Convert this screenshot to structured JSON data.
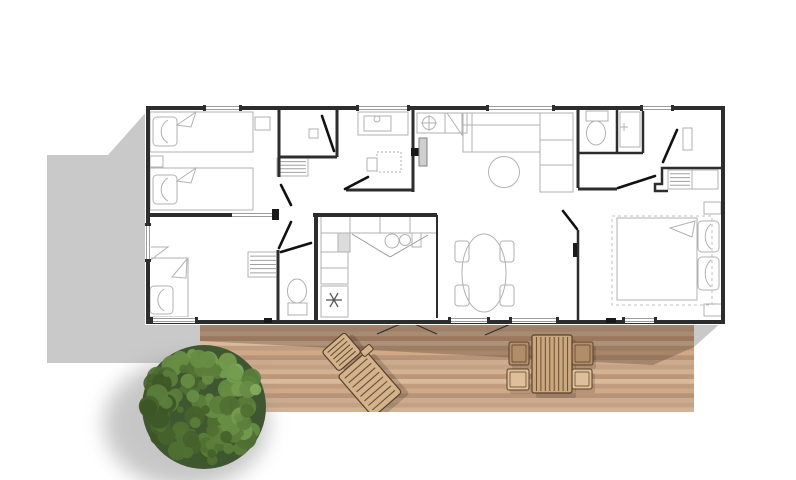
{
  "canvas": {
    "w": 796,
    "h": 480,
    "bg": "#ffffff"
  },
  "colors": {
    "wall": "#2d2d2d",
    "furniture": "#b2b2b2",
    "window": "#9c9c9c",
    "door": "#111111",
    "shadow": "#c9c9c9",
    "deck_shadow": "rgba(74,50,36,0.30)",
    "wood_outline": "#5a4028",
    "wood_slat": "#6b4e35",
    "swing": "#333333",
    "door_leaf_fill": "#cfcfcf",
    "door_leaf_stroke": "#808080",
    "snow": "#555555"
  },
  "ground": {
    "left_shadow": "148,110 108,155 47,155 47,363 200,363 200,322 148,322",
    "right_shadow": "694,322 722,322 694,347"
  },
  "deck": {
    "x": 200,
    "y": 322,
    "w": 494,
    "h": 90,
    "plank_h": 4.75,
    "plank_colors": [
      "#cbab8e",
      "#c19c7f",
      "#d3b294",
      "#b99377",
      "#d8bb9d",
      "#c4a184",
      "#cfa988",
      "#bd9678"
    ],
    "shadow_pts": "200,322 694,322 694,347 653,365 200,341",
    "door_swings": [
      [
        405,
        322,
        377,
        334
      ],
      [
        410,
        322,
        437,
        334
      ],
      [
        513,
        323,
        485,
        335
      ]
    ]
  },
  "deck_furniture": {
    "table": {
      "x": 532,
      "y": 335,
      "w": 40,
      "h": 58,
      "fill": "#c9a87e",
      "slats": 8
    },
    "chairs": [
      {
        "x": 509,
        "y": 342,
        "w": 20,
        "h": 23,
        "fill": "#b18e6a"
      },
      {
        "x": 507,
        "y": 369,
        "w": 22,
        "h": 21,
        "fill": "#ddc09a"
      },
      {
        "x": 572,
        "y": 342,
        "w": 21,
        "h": 23,
        "fill": "#b18e6a"
      },
      {
        "x": 572,
        "y": 369,
        "w": 20,
        "h": 20,
        "fill": "#ddc09a"
      }
    ],
    "lounger": {
      "rotate": -41,
      "cx": 360,
      "cy": 373,
      "fill": "#d2b38c",
      "back": {
        "x": 345,
        "y": 332,
        "w": 30,
        "h": 26
      },
      "seat": {
        "x": 341,
        "y": 361,
        "w": 38,
        "h": 54
      },
      "arm": {
        "x": 374,
        "y": 357,
        "w": 12,
        "h": 7
      }
    }
  },
  "tree": {
    "cx": 204,
    "cy": 407,
    "r": 62,
    "base": "#3f5730",
    "blobs": 135,
    "palette": [
      "#33491f",
      "#3d5626",
      "#46622c",
      "#507033",
      "#5b7e3b",
      "#678d44",
      "#749c4e",
      "#83ab5c"
    ],
    "shadow": {
      "cx": 186,
      "cy": 424,
      "rx": 82,
      "ry": 64
    }
  },
  "building": {
    "x": 148,
    "y": 108,
    "w": 575,
    "h": 214,
    "windows_top": [
      [
        205,
        240
      ],
      [
        358,
        408
      ],
      [
        488,
        553
      ],
      [
        642,
        672
      ]
    ],
    "windows_bottom": [
      [
        152,
        196
      ],
      [
        450,
        488
      ],
      [
        511,
        557
      ],
      [
        624,
        655
      ]
    ],
    "windows_left": [
      [
        225,
        260
      ]
    ],
    "h1_gray": [
      232,
      276
    ],
    "walls": [
      [
        279,
        108,
        279,
        177,
        3
      ],
      [
        279,
        157,
        337,
        157,
        3
      ],
      [
        337,
        108,
        337,
        157,
        3
      ],
      [
        148,
        215,
        232,
        215,
        4
      ],
      [
        413,
        108,
        413,
        192,
        3
      ],
      [
        346,
        190,
        413,
        190,
        3
      ],
      [
        313,
        215,
        437,
        215,
        4
      ],
      [
        316,
        215,
        316,
        322,
        4
      ],
      [
        278,
        250,
        278,
        322,
        3
      ],
      [
        437,
        215,
        437,
        318,
        2
      ],
      [
        578,
        108,
        578,
        188,
        3
      ],
      [
        578,
        153,
        643,
        153,
        2.5
      ],
      [
        617,
        108,
        617,
        153,
        2.5
      ],
      [
        643,
        108,
        643,
        153,
        2.5
      ],
      [
        578,
        189,
        617,
        189,
        3
      ],
      [
        578,
        230,
        578,
        322,
        2.5
      ]
    ],
    "wardrobe_wall": "M722,168 L662,168 L662,184 L655,184 L655,191 L668,191",
    "doors": [
      [
        322,
        116,
        334,
        151
      ],
      [
        345,
        189,
        368,
        177
      ],
      [
        281,
        185,
        291,
        205
      ],
      [
        291,
        222,
        279,
        248
      ],
      [
        618,
        188,
        655,
        176
      ],
      [
        677,
        130,
        663,
        162
      ],
      [
        563,
        211,
        577,
        229
      ],
      [
        281,
        252,
        311,
        243
      ]
    ],
    "marks": [
      [
        272,
        209,
        7,
        11
      ],
      [
        264,
        318,
        8,
        5
      ],
      [
        606,
        318,
        10,
        5
      ],
      [
        573,
        243,
        4,
        14
      ],
      [
        411,
        148,
        8,
        8
      ]
    ],
    "door_leaf": {
      "x": 419,
      "y": 138,
      "w": 8,
      "h": 28
    }
  },
  "plan_items": [
    {
      "name": "bed-single",
      "t": "rect",
      "x": 150,
      "y": 112,
      "w": 103,
      "h": 40
    },
    {
      "name": "pillow",
      "t": "pillow",
      "x": 153,
      "y": 117,
      "w": 24,
      "h": 29
    },
    {
      "name": "blanket-fold",
      "t": "poly",
      "p": "177,125 196,112 191,127"
    },
    {
      "name": "bed-single",
      "t": "rect",
      "x": 150,
      "y": 168,
      "w": 103,
      "h": 42
    },
    {
      "name": "pillow",
      "t": "pillow",
      "x": 153,
      "y": 175,
      "w": 24,
      "h": 29
    },
    {
      "name": "blanket-fold",
      "t": "poly",
      "p": "177,181 196,168 191,183"
    },
    {
      "name": "nightstand",
      "t": "rect",
      "x": 150,
      "y": 156,
      "w": 13,
      "h": 11
    },
    {
      "name": "side-table",
      "t": "rect",
      "x": 255,
      "y": 117,
      "w": 15,
      "h": 13
    },
    {
      "name": "bed-single",
      "t": "rect",
      "x": 147,
      "y": 258,
      "w": 41,
      "h": 59
    },
    {
      "name": "pillow",
      "t": "pillow",
      "x": 150,
      "y": 286,
      "w": 23,
      "h": 28
    },
    {
      "name": "blanket-fold",
      "t": "poly",
      "p": "172,277 187,259 186,278"
    },
    {
      "name": "corner-desk",
      "t": "poly",
      "p": "148,247 168,247 148,262"
    },
    {
      "name": "shelf-unit",
      "t": "stripes",
      "x": 248,
      "y": 252,
      "w": 30,
      "h": 25,
      "n": 5
    },
    {
      "name": "shelf-unit",
      "t": "stripes",
      "x": 277,
      "y": 158,
      "w": 31,
      "h": 18,
      "n": 4
    },
    {
      "name": "shower-drain",
      "t": "rect",
      "x": 309,
      "y": 129,
      "w": 9,
      "h": 9
    },
    {
      "name": "vanity",
      "t": "rect",
      "x": 358,
      "y": 112,
      "w": 50,
      "h": 23
    },
    {
      "name": "washbasin",
      "t": "rect",
      "x": 364,
      "y": 116,
      "w": 27,
      "h": 15
    },
    {
      "name": "faucet",
      "t": "circle",
      "cx": 377,
      "cy": 119,
      "r": 3
    },
    {
      "name": "shower-tray",
      "t": "rect",
      "x": 377,
      "y": 152,
      "w": 24,
      "h": 20,
      "dash": "2,2"
    },
    {
      "name": "bath-cabinet",
      "t": "rect",
      "x": 367,
      "y": 158,
      "w": 10,
      "h": 13
    },
    {
      "name": "entry-cabinet",
      "t": "rect",
      "x": 417,
      "y": 113,
      "w": 50,
      "h": 20
    },
    {
      "name": "ceiling-light",
      "t": "circle",
      "cx": 429,
      "cy": 123,
      "r": 6.5
    },
    {
      "name": "light-cross",
      "t": "line",
      "x1": 421,
      "y1": 123,
      "x2": 437,
      "y2": 123
    },
    {
      "name": "light-cross",
      "t": "line",
      "x1": 429,
      "y1": 115,
      "x2": 429,
      "y2": 131
    },
    {
      "name": "corner-shelf",
      "t": "poly",
      "p": "447,113 462,113 462,135"
    },
    {
      "name": "cabinet-divider",
      "t": "line",
      "x1": 445,
      "y1": 113,
      "x2": 445,
      "y2": 133
    },
    {
      "name": "sofa",
      "t": "rect",
      "x": 463,
      "y": 113,
      "w": 77,
      "h": 39
    },
    {
      "name": "sofa-back-line",
      "t": "line",
      "x1": 463,
      "y1": 125,
      "x2": 540,
      "y2": 125
    },
    {
      "name": "sofa-arm-line",
      "t": "line",
      "x1": 472,
      "y1": 113,
      "x2": 472,
      "y2": 152
    },
    {
      "name": "sofa-chaise",
      "t": "rect",
      "x": 540,
      "y": 113,
      "w": 33,
      "h": 79
    },
    {
      "name": "sofa-cushion-line",
      "t": "line",
      "x1": 540,
      "y1": 140,
      "x2": 573,
      "y2": 140
    },
    {
      "name": "sofa-cushion-line",
      "t": "line",
      "x1": 540,
      "y1": 165,
      "x2": 573,
      "y2": 165
    },
    {
      "name": "coffee-table",
      "t": "circle",
      "cx": 504,
      "cy": 172,
      "r": 15.5
    },
    {
      "name": "toilet",
      "t": "ellipse",
      "cx": 297,
      "cy": 291,
      "rx": 9.5,
      "ry": 12
    },
    {
      "name": "toilet-tank",
      "t": "rect",
      "x": 288,
      "y": 303,
      "w": 19,
      "h": 12
    },
    {
      "name": "kitchen-counter",
      "t": "rect",
      "x": 321,
      "y": 215,
      "w": 116,
      "h": 18
    },
    {
      "name": "counter-divider",
      "t": "line",
      "x1": 350,
      "y1": 215,
      "x2": 350,
      "y2": 233
    },
    {
      "name": "counter-divider",
      "t": "line",
      "x1": 380,
      "y1": 215,
      "x2": 380,
      "y2": 233
    },
    {
      "name": "counter-divider",
      "t": "line",
      "x1": 410,
      "y1": 215,
      "x2": 410,
      "y2": 233
    },
    {
      "name": "hob-burner",
      "t": "circle",
      "cx": 392,
      "cy": 241,
      "r": 7
    },
    {
      "name": "hob-burner",
      "t": "circle",
      "cx": 405,
      "cy": 240,
      "r": 5.5
    },
    {
      "name": "kitchen-appliance",
      "t": "rect",
      "x": 412,
      "y": 233,
      "w": 9,
      "h": 14
    },
    {
      "name": "kitchen-sink",
      "t": "rect",
      "x": 338,
      "y": 233,
      "w": 12,
      "h": 19,
      "fill": "#dcdcdc"
    },
    {
      "name": "kitchen-cabinet",
      "t": "rect",
      "x": 321,
      "y": 233,
      "w": 17,
      "h": 19
    },
    {
      "name": "kitchen-cabinet",
      "t": "rect",
      "x": 321,
      "y": 252,
      "w": 27,
      "h": 16
    },
    {
      "name": "kitchen-cabinet",
      "t": "rect",
      "x": 321,
      "y": 268,
      "w": 27,
      "h": 16
    },
    {
      "name": "fridge",
      "t": "rect",
      "x": 321,
      "y": 286,
      "w": 27,
      "h": 31
    },
    {
      "name": "cabinet-door-line",
      "t": "line",
      "x1": 352,
      "y1": 234,
      "x2": 390,
      "y2": 257,
      "stroke": "#999999"
    },
    {
      "name": "cabinet-door-line",
      "t": "line",
      "x1": 390,
      "y1": 257,
      "x2": 428,
      "y2": 235,
      "stroke": "#999999"
    },
    {
      "name": "snowflake-icon",
      "t": "snow",
      "cx": 334,
      "cy": 300,
      "r": 8
    },
    {
      "name": "dining-table",
      "t": "ellipse",
      "cx": 484,
      "cy": 273,
      "rx": 22,
      "ry": 39
    },
    {
      "name": "dining-chair",
      "t": "rect",
      "x": 455,
      "y": 241,
      "w": 14,
      "h": 21,
      "rx": 3
    },
    {
      "name": "dining-chair",
      "t": "rect",
      "x": 455,
      "y": 285,
      "w": 14,
      "h": 21,
      "rx": 3
    },
    {
      "name": "dining-chair",
      "t": "rect",
      "x": 500,
      "y": 241,
      "w": 14,
      "h": 21,
      "rx": 3
    },
    {
      "name": "dining-chair",
      "t": "rect",
      "x": 500,
      "y": 285,
      "w": 14,
      "h": 21,
      "rx": 3
    },
    {
      "name": "toilet",
      "t": "ellipse",
      "cx": 596,
      "cy": 133,
      "rx": 9.5,
      "ry": 12
    },
    {
      "name": "toilet-tank",
      "t": "rect",
      "x": 586,
      "y": 111,
      "w": 22,
      "h": 10
    },
    {
      "name": "washbasin",
      "t": "rect",
      "x": 620,
      "y": 112,
      "w": 20,
      "h": 35
    },
    {
      "name": "faucet",
      "t": "line",
      "x1": 620,
      "y1": 127,
      "x2": 628,
      "y2": 127
    },
    {
      "name": "faucet",
      "t": "line",
      "x1": 624,
      "y1": 123,
      "x2": 624,
      "y2": 131
    },
    {
      "name": "mirror",
      "t": "rect",
      "x": 683,
      "y": 128,
      "w": 9,
      "h": 22
    },
    {
      "name": "wardrobe-shelves",
      "t": "stripes",
      "x": 668,
      "y": 170,
      "w": 24,
      "h": 19,
      "n": 4
    },
    {
      "name": "wardrobe",
      "t": "rect",
      "x": 692,
      "y": 170,
      "w": 26,
      "h": 19
    },
    {
      "name": "rug",
      "t": "rect",
      "x": 612,
      "y": 216,
      "w": 100,
      "h": 89,
      "dash": "3,3",
      "stroke": "#c0c0c0"
    },
    {
      "name": "bed-double",
      "t": "rect",
      "x": 617,
      "y": 218,
      "w": 80,
      "h": 82
    },
    {
      "name": "pillow",
      "t": "pillow",
      "x": 698,
      "y": 221,
      "w": 21,
      "h": 31
    },
    {
      "name": "pillow",
      "t": "pillow",
      "x": 698,
      "y": 257,
      "w": 21,
      "h": 33
    },
    {
      "name": "blanket-fold",
      "t": "poly",
      "p": "695,221 670,228 692,237"
    },
    {
      "name": "nightstand",
      "t": "rect",
      "x": 704,
      "y": 202,
      "w": 17,
      "h": 12
    },
    {
      "name": "nightstand",
      "t": "rect",
      "x": 704,
      "y": 304,
      "w": 18,
      "h": 12
    }
  ]
}
